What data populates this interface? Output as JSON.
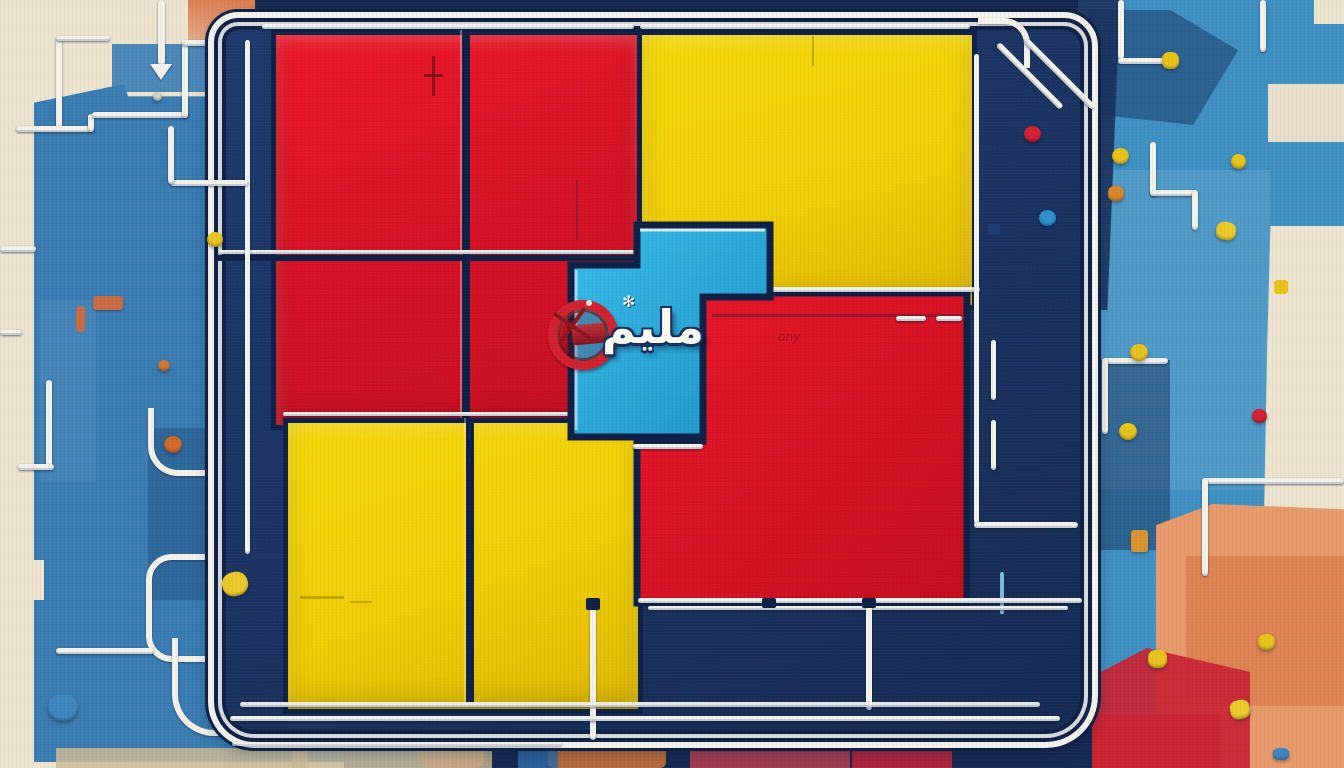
{
  "artwork": {
    "glyph_text": "مليم",
    "sparkle_mark": "✻",
    "scribble_text": "ony"
  },
  "colors": {
    "cream": "#EDE4CF",
    "cream2": "#E9DFCA",
    "salmon": "#DC7E52",
    "salmon-light": "#E79A6B",
    "salmon-deep": "#DB7F4F",
    "blue-mid": "#3A7CB1",
    "blue-mid-light": "#4C88BA",
    "blue-light": "#3E90C2",
    "navy": "#1E3A6D",
    "navy-deep": "#152A52",
    "navy-line": "#0E2046",
    "red-bright": "#EC1728",
    "red-deep": "#C30F20",
    "red-patch": "#C92433",
    "yellow": "#F4D808",
    "yellow-deep": "#DFBA04",
    "gold": "#E7C31B",
    "cyan": "#2FB2E2",
    "cyan-deep": "#1D93C6",
    "pipe": "#F3F2EA",
    "orange": "#CF6A2A",
    "beige": "#CDBB97"
  }
}
